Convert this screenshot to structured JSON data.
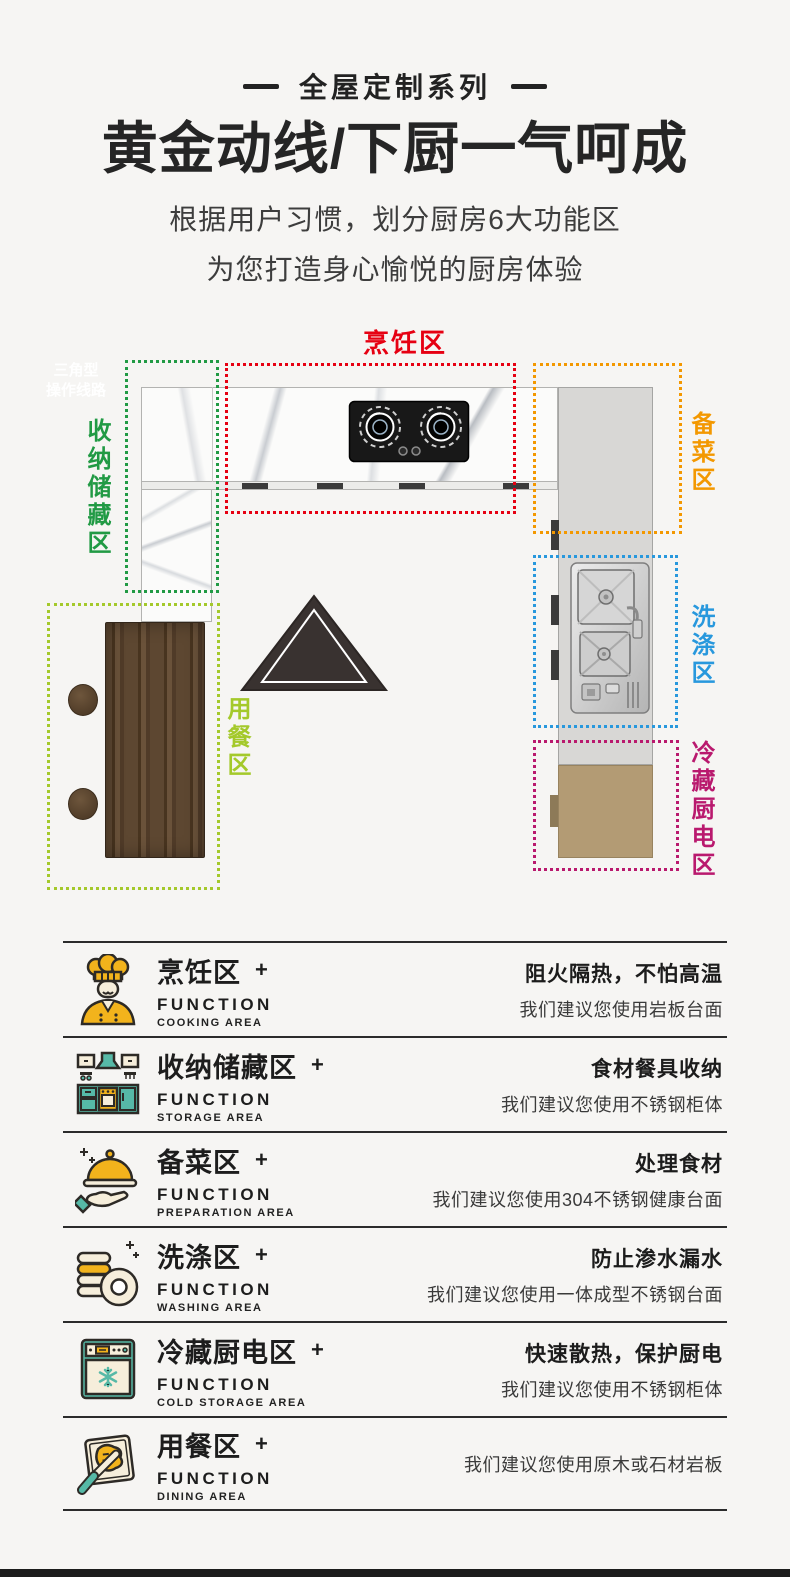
{
  "header": {
    "series_tag": "全屋定制系列",
    "title": "黄金动线/下厨一气呵成",
    "subtitle1": "根据用户习惯，划分厨房6大功能区",
    "subtitle2": "为您打造身心愉悦的厨房体验"
  },
  "colors": {
    "red": "#e60012",
    "green": "#219a44",
    "orange": "#f39800",
    "blue": "#2898dd",
    "magenta": "#b9196e",
    "yellow_green": "#a4c92b",
    "icon_yellow": "#f2b31c",
    "icon_teal": "#56b9a7",
    "icon_cream": "#f6eedb"
  },
  "diagram": {
    "triangle": {
      "line1": "三角型",
      "line2": "操作线路"
    },
    "zones": [
      {
        "id": "cooking",
        "label": "烹饪区",
        "color": "#e60012"
      },
      {
        "id": "storage",
        "label": "收纳储藏区",
        "color": "#219a44"
      },
      {
        "id": "preparation",
        "label": "备菜区",
        "color": "#f39800"
      },
      {
        "id": "washing",
        "label": "洗涤区",
        "color": "#2898dd"
      },
      {
        "id": "cold",
        "label": "冷藏厨电区",
        "color": "#b9196e"
      },
      {
        "id": "dining",
        "label": "用餐区",
        "color": "#a4c92b"
      }
    ]
  },
  "function_list": [
    {
      "name": "烹饪区",
      "plus": "+",
      "function_label": "FUNCTION",
      "area_label": "COOKING AREA",
      "benefit": "阻火隔热，不怕高温",
      "suggestion": "我们建议您使用岩板台面"
    },
    {
      "name": "收纳储藏区",
      "plus": "+",
      "function_label": "FUNCTION",
      "area_label": "STORAGE AREA",
      "benefit": "食材餐具收纳",
      "suggestion": "我们建议您使用不锈钢柜体"
    },
    {
      "name": "备菜区",
      "plus": "+",
      "function_label": "FUNCTION",
      "area_label": "PREPARATION AREA",
      "benefit": "处理食材",
      "suggestion": "我们建议您使用304不锈钢健康台面"
    },
    {
      "name": "洗涤区",
      "plus": "+",
      "function_label": "FUNCTION",
      "area_label": "WASHING AREA",
      "benefit": "防止渗水漏水",
      "suggestion": "我们建议您使用一体成型不锈钢台面"
    },
    {
      "name": "冷藏厨电区",
      "plus": "+",
      "function_label": "FUNCTION",
      "area_label": "COLD STORAGE AREA",
      "benefit": "快速散热，保护厨电",
      "suggestion": "我们建议您使用不锈钢柜体"
    },
    {
      "name": "用餐区",
      "plus": "+",
      "function_label": "FUNCTION",
      "area_label": "DINING AREA",
      "benefit": "",
      "suggestion": "我们建议您使用原木或石材岩板"
    }
  ]
}
